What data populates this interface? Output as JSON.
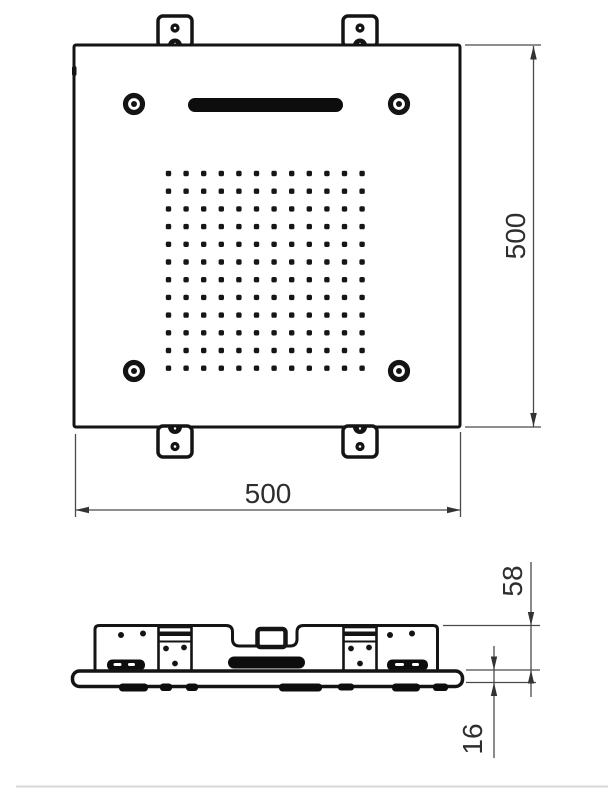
{
  "top_view": {
    "dim_width_label": "500",
    "dim_height_label": "500",
    "nozzle_grid": {
      "rows": 12,
      "cols": 12
    },
    "screw_hole_count": 4,
    "mounting_tab_count": 4
  },
  "side_view": {
    "dim_recess_depth_label": "58",
    "dim_plate_thickness_label": "16"
  },
  "colors": {
    "line": "#141414",
    "dimension": "#4a4a4a",
    "text": "#2e2e2e",
    "background": "#ffffff"
  }
}
